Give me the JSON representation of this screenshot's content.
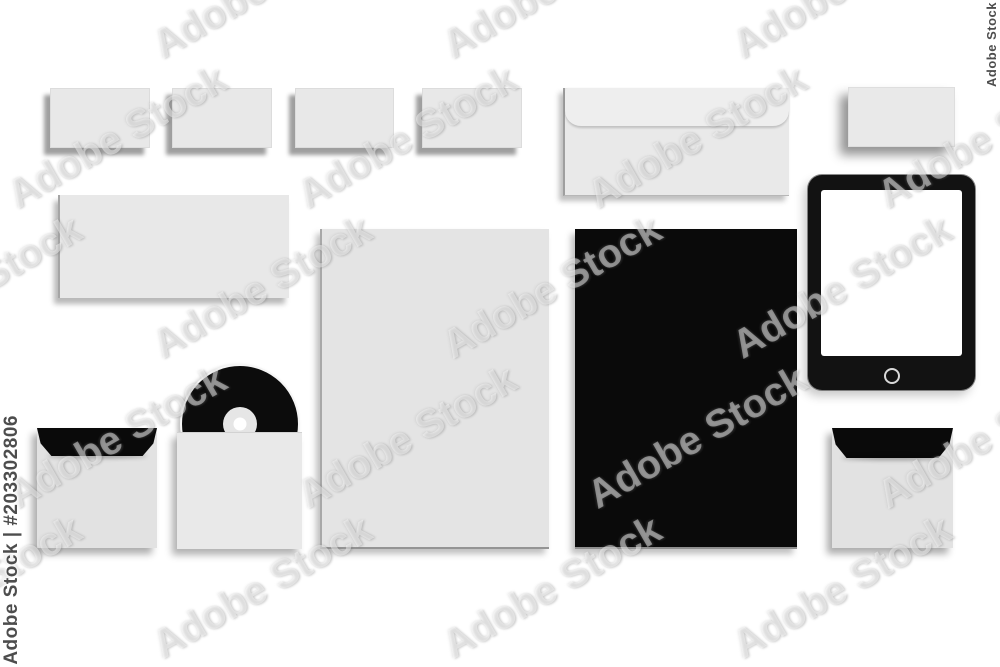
{
  "watermark": {
    "brand": "Adobe Stock",
    "asset_id": "#203302806",
    "left_label": "Adobe Stock | #203302806",
    "right_label": "Adobe Stock",
    "tile_text": "Adobe Stock",
    "side_text_color": "#4d4d4d"
  },
  "scene": {
    "description_items": [
      {
        "name": "business-card-1",
        "color": "#e8e8e8"
      },
      {
        "name": "business-card-2",
        "color": "#e8e8e8"
      },
      {
        "name": "business-card-3",
        "color": "#e8e8e8"
      },
      {
        "name": "business-card-4",
        "color": "#e8e8e8"
      },
      {
        "name": "dl-envelope",
        "color": "#e9e9e9"
      },
      {
        "name": "small-card",
        "color": "#e9e9e9"
      },
      {
        "name": "compliment-slip",
        "color": "#e8e8e8"
      },
      {
        "name": "letterhead-light",
        "color": "#e4e4e4"
      },
      {
        "name": "letterhead-black",
        "color": "#0a0a0a"
      },
      {
        "name": "tablet",
        "frame_color": "#121212",
        "screen_color": "#ffffff"
      },
      {
        "name": "cd-disc",
        "color": "#0c0c0c",
        "hub_color": "#ffffff"
      },
      {
        "name": "cd-sleeve",
        "color": "#e9e9e9"
      },
      {
        "name": "square-envelope-left",
        "body_color": "#e2e2e2",
        "flap_color": "#0a0a0a"
      },
      {
        "name": "square-envelope-right",
        "body_color": "#e2e2e2",
        "flap_color": "#0a0a0a"
      }
    ],
    "background_color": "#ffffff",
    "shadow_color": "#8a8a8a"
  }
}
